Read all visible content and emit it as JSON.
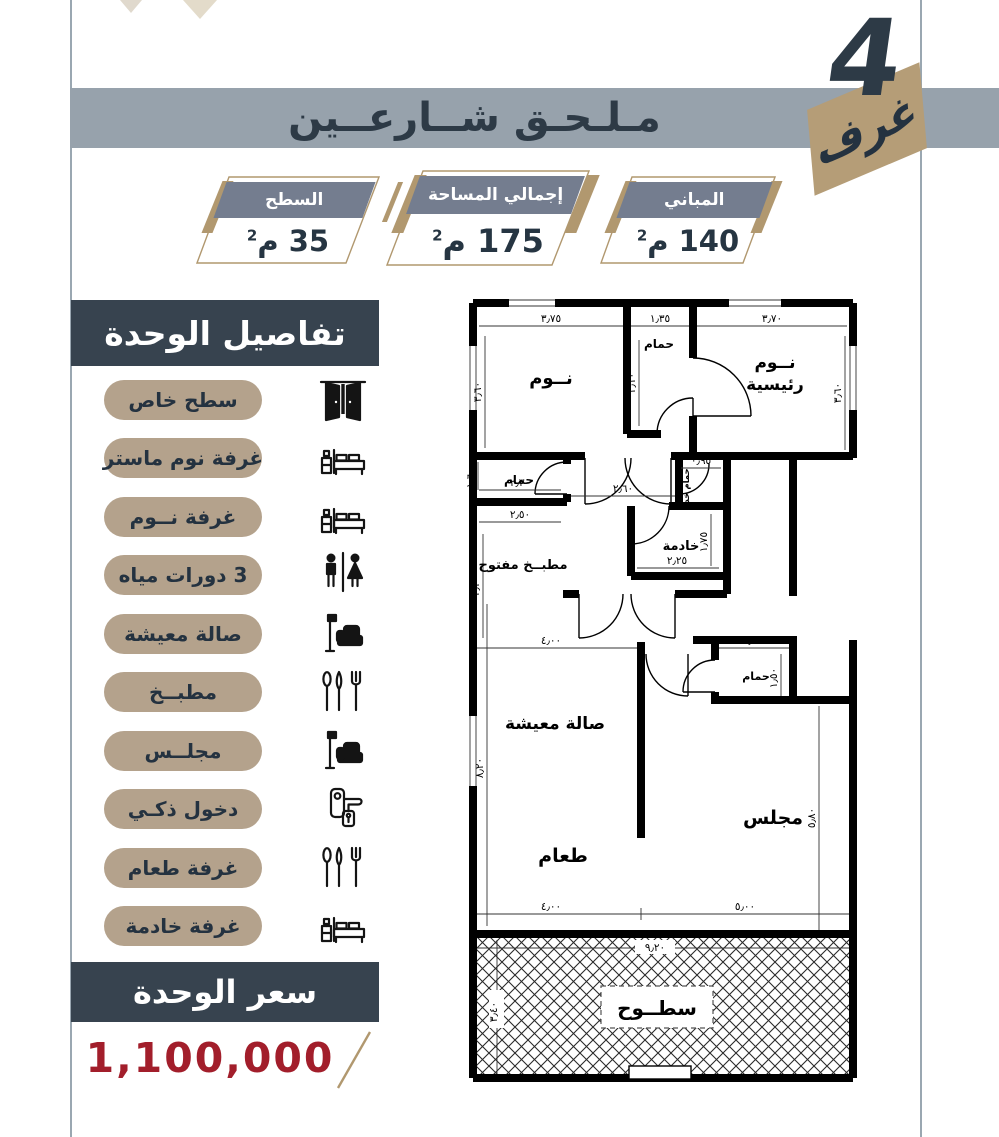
{
  "header": {
    "title": "مـلـحـق شــارعــين",
    "rooms_count": "4",
    "rooms_label": "غرف"
  },
  "stats": [
    {
      "label": "المباني",
      "value": "140",
      "unit": "م",
      "sup": "2"
    },
    {
      "label": "إجمالي المساحة",
      "value": "175",
      "unit": "م",
      "sup": "2"
    },
    {
      "label": "السطح",
      "value": "35",
      "unit": "م",
      "sup": "2"
    }
  ],
  "sidebar": {
    "title": "تفاصيل الوحدة",
    "items": [
      {
        "label": "سطح خاص",
        "icon": "door-icon"
      },
      {
        "label": "غرفة نوم ماستر",
        "icon": "bed-icon"
      },
      {
        "label": "غرفة نــوم",
        "icon": "bed-icon"
      },
      {
        "label": "3 دورات مياه",
        "icon": "wc-icon"
      },
      {
        "label": "صالة معيشة",
        "icon": "sofa-lamp-icon"
      },
      {
        "label": "مطبــخ",
        "icon": "cutlery-icon"
      },
      {
        "label": "مجلــس",
        "icon": "sofa-lamp-icon"
      },
      {
        "label": "دخول ذكـي",
        "icon": "smart-lock-icon"
      },
      {
        "label": "غرفة طعام",
        "icon": "cutlery-icon"
      },
      {
        "label": "غرفة خادمة",
        "icon": "bed-icon"
      }
    ]
  },
  "price": {
    "title": "سعر الوحدة",
    "value": "1,100,000"
  },
  "floor_plan": {
    "labels": {
      "bedroom": "نــوم",
      "bath_top": "حمام",
      "master_1": "نــوم",
      "master_2": "رئيسية",
      "bath_left": "حمام",
      "kitchen": "مطبــخ مفتوح",
      "maid_bath": "حمام خد",
      "maid": "خادمة",
      "living": "صالة معيشة",
      "dining": "طعام",
      "majlis": "مجلس",
      "bath_majlis": "حمام",
      "roof": "سطــوح"
    },
    "dims": {
      "top_left_room": "٣٫٧٥",
      "top_bath": "١٫٣٥",
      "top_right_room": "٣٫٧٠",
      "bedroom_height": "٣٫٦٠",
      "master_height": "٣٫٦٠",
      "bath_height": "٢٫١٠",
      "bath_left_w": "٢٫٣٠",
      "bath_left_h": "١٫٦٠",
      "hall_w": "٢٫٦٠",
      "kitchen_w": "٢٫٥٠",
      "kitchen_h": "٣٫٢٠",
      "maid_bath_w": "٠٫٩٥",
      "maid_w": "٢٫٢٥",
      "maid_h": "١٫٧٥",
      "living_w": "٤٫٠٠",
      "living_h": "٨٫٢٠",
      "bath_majlis_w": "١٫٦٠",
      "bath_majlis_h": "١٫٥٠",
      "majlis_h": "٥٫٨٠",
      "bottom_left": "٤٫٠٠",
      "bottom_right": "٥٫٠٠",
      "roof_w": "٩٫٢٠",
      "roof_h": "٣٫٤٠"
    }
  },
  "colors": {
    "navy": "#2d3a46",
    "band_gray": "#97a2ac",
    "banner_slate": "#747d8f",
    "tan_gold": "#b1986f",
    "pill_tan": "#b4a28c",
    "price_red": "#a21e2b"
  }
}
